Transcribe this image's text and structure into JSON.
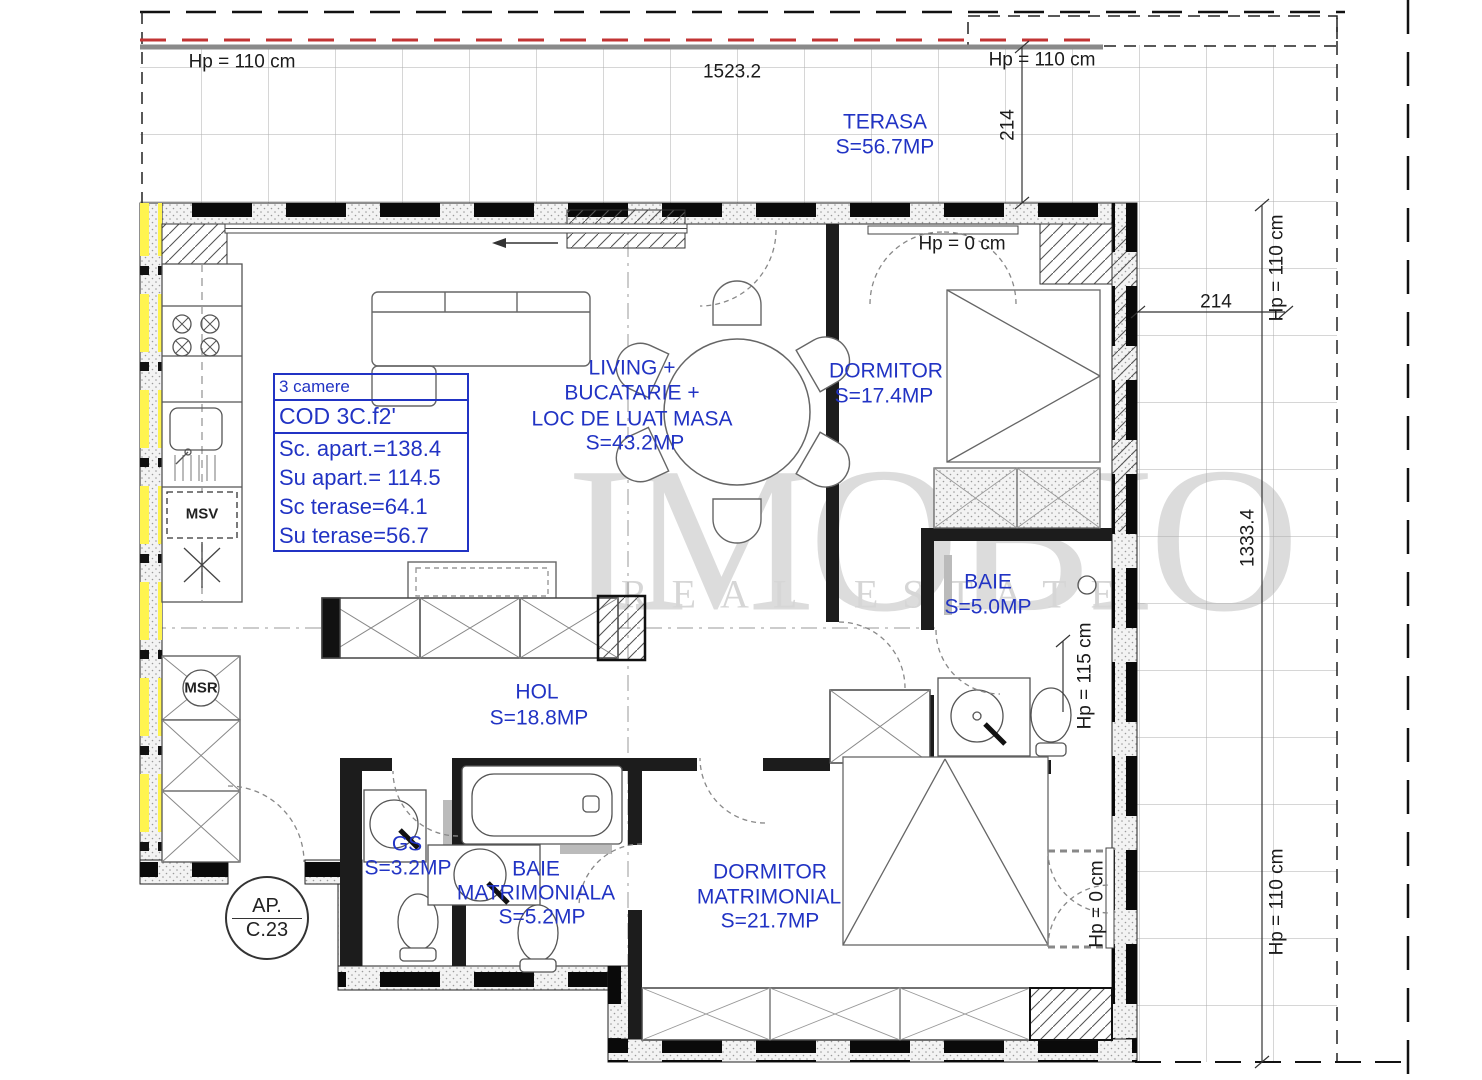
{
  "watermark": {
    "name": "IMOBIO",
    "tagline": "REAL ESTATE"
  },
  "info_box": {
    "rooms_count": "3 camere",
    "code": "COD  3C.f2'",
    "built_area": "Sc. apart.=138.4",
    "usable_area": "Su apart.= 114.5",
    "terrace_built": "Sc terase=64.1",
    "terrace_usable": "Su terase=56.7"
  },
  "apartment_badge": {
    "line1": "AP.",
    "line2": "C.23"
  },
  "rooms": {
    "terasa": {
      "name": "TERASA",
      "area": "S=56.7MP"
    },
    "living": {
      "l1": "LIVING +",
      "l2": "BUCATARIE +",
      "l3": "LOC DE LUAT MASA",
      "area": "S=43.2MP"
    },
    "dormitor": {
      "name": "DORMITOR",
      "area": "S=17.4MP"
    },
    "baie": {
      "name": "BAIE",
      "area": "S=5.0MP"
    },
    "hol": {
      "name": "HOL",
      "area": "S=18.8MP"
    },
    "gs": {
      "name": "GS",
      "area": "S=3.2MP"
    },
    "baie_matrimoniala": {
      "l1": "BAIE",
      "l2": "MATRIMONIALA",
      "area": "S=5.2MP"
    },
    "dormitor_matrimonial": {
      "l1": "DORMITOR",
      "l2": "MATRIMONIAL",
      "area": "S=21.7MP"
    }
  },
  "dimensions": {
    "hp110_top_left": "Hp = 110 cm",
    "hp110_top_right": "Hp = 110 cm",
    "hp110_right_upper": "Hp = 110 cm",
    "hp110_right_lower": "Hp = 110 cm",
    "hp0_dormitor": "Hp = 0 cm",
    "hp0_bottom_right": "Hp = 0 cm",
    "hp115_baie": "Hp = 115 cm",
    "len_top": "1523.2",
    "len_214_top": "214",
    "len_214_right": "214",
    "len_right": "1333.4"
  },
  "equipment": {
    "msv": "MSV",
    "msr": "MSR"
  },
  "colors": {
    "label_blue": "#2133c4",
    "dim_black": "#1b1b1b",
    "wall_black": "#0a0a0a",
    "yellow_highlight": "#fff44f",
    "red_boundary": "#c23434",
    "grid_gray": "#adadad",
    "watermark_gray": "#dcdcdc"
  }
}
